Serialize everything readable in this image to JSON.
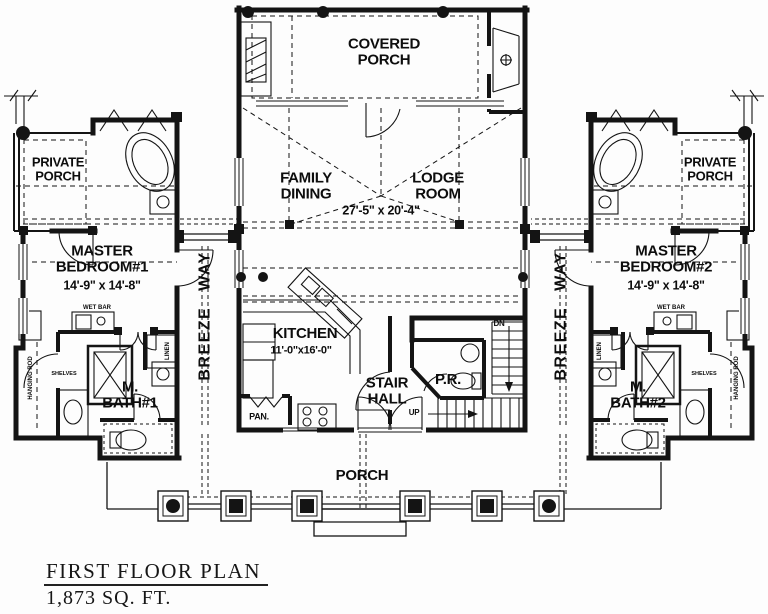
{
  "plan": {
    "footer": {
      "title": "FIRST FLOOR PLAN",
      "area": "1,873  SQ. FT."
    },
    "rooms": {
      "covered_porch": "COVERED\nPORCH",
      "private_porch_left": "PRIVATE\nPORCH",
      "private_porch_right": "PRIVATE\nPORCH",
      "master_bedroom1": "MASTER\nBEDROOM#1",
      "master_bedroom1_dim": "14'-9\" x 14'-8\"",
      "master_bedroom2": "MASTER\nBEDROOM#2",
      "master_bedroom2_dim": "14'-9\" x 14'-8\"",
      "family_dining": "FAMILY\nDINING",
      "lodge_room": "LODGE\nROOM",
      "lodge_dim": "27'-5\" x 20'-4\"",
      "kitchen": "KITCHEN",
      "kitchen_dim": "11'-0\"x16'-0\"",
      "stair_hall": "STAIR\nHALL",
      "powder_room": "P.R.",
      "pantry": "PAN.",
      "master_bath1": "M.\nBATH#1",
      "master_bath2": "M.\nBATH#2",
      "breezeway_left": "BREEZE WAY",
      "breezeway_right": "BREEZE WAY",
      "porch": "PORCH"
    },
    "fixtures": {
      "wet_bar_left": "WET BAR",
      "wet_bar_right": "WET BAR",
      "hanging_rod_left": "HANGING ROD",
      "hanging_rod_right": "HANGING ROD",
      "linen_left": "LINEN",
      "linen_right": "LINEN",
      "shelves_left": "SHELVES",
      "shelves_right": "SHELVES",
      "stairs_down": "DN",
      "stairs_up": "UP"
    },
    "colors": {
      "line": "#141414",
      "background": "#fdfdfd"
    }
  }
}
